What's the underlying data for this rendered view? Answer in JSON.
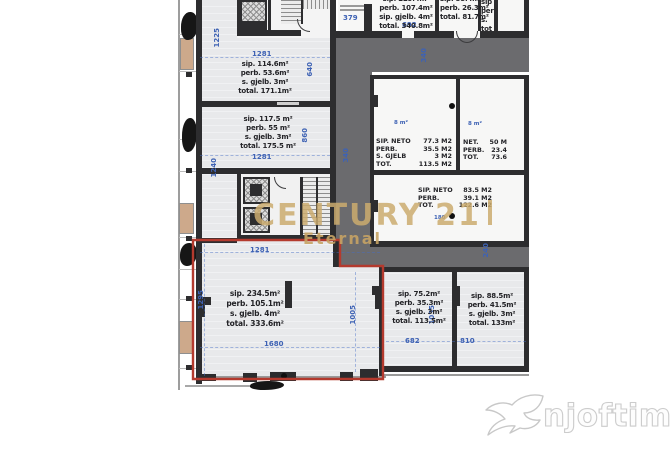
{
  "watermark": {
    "brand": "CENTURY 21",
    "brand_sub": "Eternal",
    "brand_color": "#cbac6e",
    "site": "njoftime.al"
  },
  "units": {
    "a": {
      "dim_top": "1281",
      "l1": "sip.  114.6m²",
      "l2": "perb.  53.6m²",
      "l3": "s. gjelb.  3m²",
      "l4": "total.  171.1m²",
      "dim_right": "640"
    },
    "b": {
      "l1": "sip.  117.5 m²",
      "l2": "perb.  55 m²",
      "l3": "s. gjelb.  3m²",
      "l4": "total.  175.5 m²",
      "dim_bottom": "1281",
      "dim_right": "860",
      "dim_left": "1240"
    },
    "red": {
      "dim_top": "1281",
      "l1": "sip.  234.5m²",
      "l2": "perb.  105.1m²",
      "l3": "s. gjelb.  4m²",
      "l4": "total.  333.6m²",
      "dim_bottom": "1680",
      "dim_left": "1295",
      "dim_right": "1005",
      "outline_color": "#b43a2e"
    },
    "r682": {
      "l1": "sip.  75.2m²",
      "l2": "perb.  35.3m²",
      "l3": "s. gjelb.  3m²",
      "l4": "total.  113.5m²",
      "dim_bottom": "682",
      "dim_right": "1035"
    },
    "r810": {
      "l1": "sip.  88.5m²",
      "l2": "perb.  41.5m²",
      "l3": "s. gjelb.  3m²",
      "l4": "total.  133m²",
      "dim_bottom": "810"
    },
    "tr1": {
      "l1": "sip.  229.4m²",
      "l2": "perb.  107.4m²",
      "l3": "sip. gjelb.  4m²",
      "l4": "total.  340.8m²",
      "dim_bottom": "692"
    },
    "tr2": {
      "l1": "sip.  55.4m²",
      "l2": "perb.  26.3m²",
      "l3": "total.  81.7m²"
    },
    "tr3": {
      "l1": "sip",
      "l2": "perb",
      "l3": "s.",
      "l4": "tot"
    }
  },
  "neto": {
    "n1": {
      "rows": [
        [
          "SIP. NETO",
          "77.3 M2"
        ],
        [
          "PERB.",
          "35.5 M2"
        ],
        [
          "S. GJELB",
          "3 M2"
        ],
        [
          "TOT.",
          "113.5 M2"
        ]
      ],
      "tag": "8 m²"
    },
    "n2": {
      "rows": [
        [
          "NET.",
          "50 M"
        ],
        [
          "PERB.",
          "23.4"
        ],
        [
          "TOT.",
          "73.6"
        ]
      ],
      "tag": "8 m²"
    },
    "n3": {
      "rows": [
        [
          "SIP. NETO",
          "83.5 M2"
        ],
        [
          "PERB.",
          "39.1 M2"
        ],
        [
          "TOT.",
          "122.6 M2"
        ]
      ],
      "tag": "180"
    }
  },
  "dims": {
    "left_top": "1225",
    "core_room": "379",
    "corridor_v": "340",
    "corridor_top": "340",
    "corridor_bottom": "240"
  },
  "colors": {
    "floor": "#e8e9eb",
    "corridor": "#6b6b6e",
    "wall": "#2d2d2f",
    "dim_blue": "#3e62b4",
    "balcony_tan": "#cda98b",
    "unit_outline_red": "#b43a2e"
  }
}
